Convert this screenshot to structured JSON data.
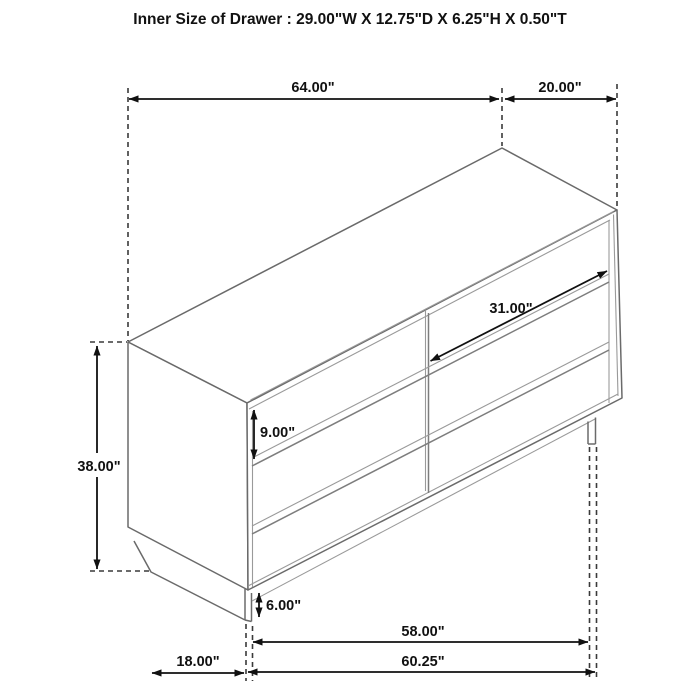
{
  "title": "Inner Size of Drawer : 29.00\"W X 12.75\"D X 6.25\"H X 0.50\"T",
  "diagram": {
    "subject": "6-drawer dresser isometric dimension drawing",
    "labels": {
      "overall_width": "64.00\"",
      "overall_depth": "20.00\"",
      "overall_height": "38.00\"",
      "drawer_front_height": "9.00\"",
      "drawer_width": "31.00\"",
      "base_height": "6.00\"",
      "base_inner_width": "58.00\"",
      "base_side_depth": "18.00\"",
      "base_outer_width": "60.25\""
    },
    "colors": {
      "background": "#ffffff",
      "cabinet_line": "#6a6a6a",
      "thin_line": "#9a9a9a",
      "groove_line": "#7d7d7d",
      "dimension_line": "#111111",
      "extension_dash": "#3a3a3a",
      "text": "#111111"
    }
  }
}
